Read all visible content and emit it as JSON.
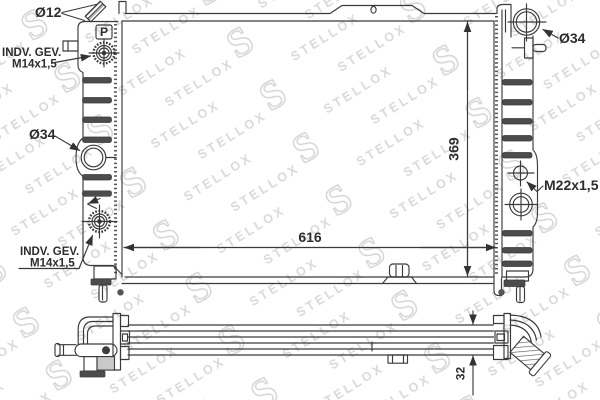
{
  "watermark": {
    "brand": "STELLOX",
    "monogram": "S"
  },
  "annotations": {
    "top_pipe_diameter": "Ø12",
    "upper_left_fitting_line1": "INDV. GEV.",
    "upper_left_fitting_line2": "M14x1,5",
    "left_hose_diameter": "Ø34",
    "lower_left_fitting_line1": "INDV. GEV.",
    "lower_left_fitting_line2": "M14x1,5",
    "right_hose_diameter": "Ø34",
    "right_fitting_thread": "M22x1,5",
    "cap_marking": "P"
  },
  "dimensions": {
    "core_width": "616",
    "core_height": "369",
    "core_depth": "32"
  }
}
